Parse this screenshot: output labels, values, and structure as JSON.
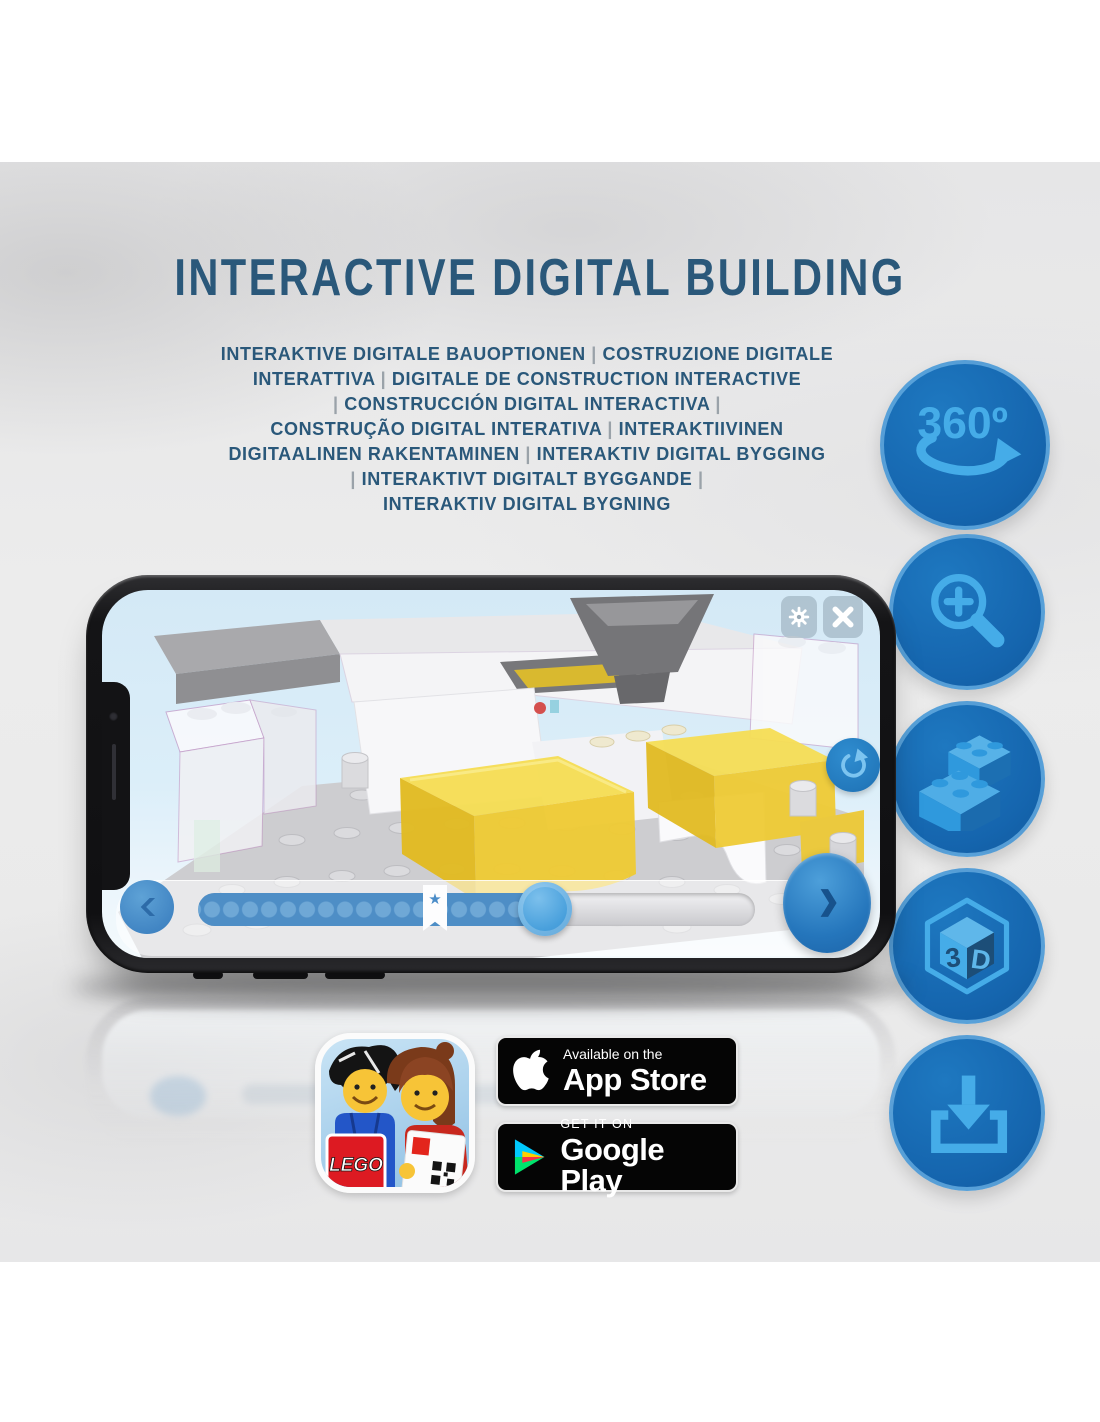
{
  "header": {
    "title": "INTERACTIVE DIGITAL BUILDING",
    "subtitle_lines": [
      "INTERAKTIVE DIGITALE BAUOPTIONEN | COSTRUZIONE DIGITALE",
      "INTERATTIVA | DIGITALE DE CONSTRUCTION INTERACTIVE",
      "| CONSTRUCCIÓN DIGITAL INTERACTIVA |",
      "CONSTRUÇÃO DIGITAL INTERATIVA | INTERAKTIIVINEN",
      "DIGITAALINEN RAKENTAMINEN | INTERAKTIV DIGITAL BYGGING",
      "| INTERAKTIVT DIGITALT BYGGANDE |",
      "INTERAKTIV DIGITAL BYGNING"
    ]
  },
  "features": {
    "labels": {
      "rotate_360": "360º"
    },
    "cube_3d": {
      "left": "3",
      "right": "D"
    },
    "icon_names": [
      "360-rotation",
      "zoom-in",
      "lego-brick",
      "3d-view",
      "download"
    ]
  },
  "phone_app": {
    "progress": {
      "bookmark_star": "★",
      "percent_complete": 60,
      "dot_count": 18
    }
  },
  "badges": {
    "app_store": {
      "line1": "Available on the",
      "line2": "App Store"
    },
    "google_play": {
      "line1": "GET IT ON",
      "line2": "Google Play"
    },
    "lego_app": {
      "logo_text": "LEGO"
    }
  },
  "colors": {
    "title_blue": "#2A587A",
    "pipe_gray": "#9AA2A9",
    "feature_circle_blue": "#1565AE",
    "feature_glyph_blue": "#45ACE8",
    "brick_yellow": "#EFCB35",
    "screen_sky_blue": "#D9ECF8",
    "progress_blue": "#4E8EC6",
    "badge_black": "#050505"
  }
}
